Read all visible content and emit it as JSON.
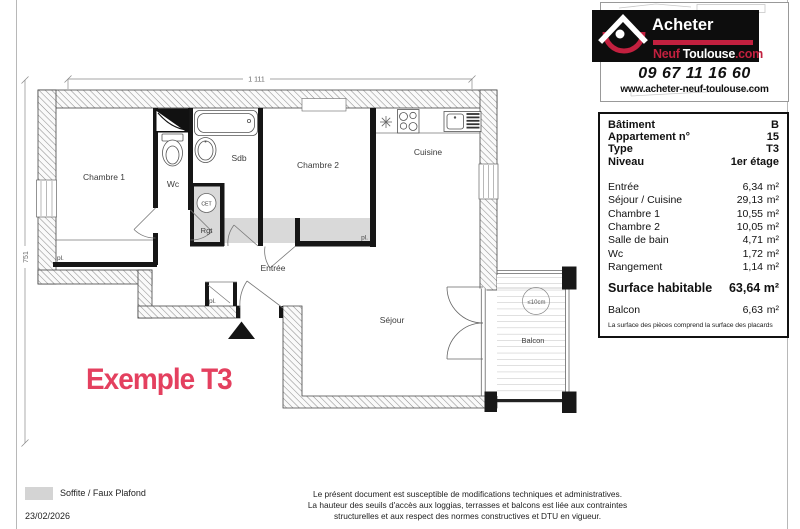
{
  "page": {
    "example_label": "Exemple T3"
  },
  "logo": {
    "brand_line1": "Acheter",
    "brand_line2_part1": "Neuf",
    "brand_line2_part2": " Toulouse",
    "brand_line2_part3": ".com",
    "phone": "09 67 11 16 60",
    "website": "www.acheter-neuf-toulouse.com"
  },
  "info_table": {
    "header_rows": [
      {
        "label": "Bâtiment",
        "value": "B"
      },
      {
        "label": "Appartement n°",
        "value": "15"
      },
      {
        "label": "Type",
        "value": "T3"
      },
      {
        "label": "Niveau",
        "value": "1er étage"
      }
    ],
    "area_rows": [
      {
        "label": "Entrée",
        "value": "6,34",
        "unit": "m²"
      },
      {
        "label": "Séjour / Cuisine",
        "value": "29,13",
        "unit": "m²"
      },
      {
        "label": "Chambre 1",
        "value": "10,55",
        "unit": "m²"
      },
      {
        "label": "Chambre 2",
        "value": "10,05",
        "unit": "m²"
      },
      {
        "label": "Salle de bain",
        "value": "4,71",
        "unit": "m²"
      },
      {
        "label": "Wc",
        "value": "1,72",
        "unit": "m²"
      },
      {
        "label": "Rangement",
        "value": "1,14",
        "unit": "m²"
      }
    ],
    "total_row": {
      "label": "Surface habitable",
      "value": "63,64 m²"
    },
    "balcony_row": {
      "label": "Balcon",
      "value": "6,63",
      "unit": "m²"
    },
    "footnote": "La surface des pièces comprend la surface des placards"
  },
  "plan": {
    "dimensions": {
      "top": "1 111",
      "left": "751"
    },
    "rooms": {
      "chambre1": "Chambre 1",
      "wc": "Wc",
      "sdb": "Sdb",
      "chambre2": "Chambre 2",
      "cuisine": "Cuisine",
      "entree": "Entrée",
      "sejour": "Séjour",
      "rgt": "Rgt",
      "balcon": "Balcon"
    },
    "labels": {
      "cet": "CET",
      "pl": "pl.",
      "balcony_note": "≤10cm"
    }
  },
  "footer": {
    "legend_label": "Soffite / Faux Plafond",
    "date": "23/02/2026",
    "disclaimer_line1": "Le présent document est susceptible de modifications techniques et administratives.",
    "disclaimer_line2": "La hauteur des seuils d'accès aux loggias, terrasses et balcons est liée aux contraintes",
    "disclaimer_line3": "structurelles et aux respect des normes constructives et DTU en vigueur."
  },
  "colors": {
    "accent_pink": "#e4405f",
    "logo_red": "#c2203f",
    "soffit_gray": "#d9d9d9"
  }
}
